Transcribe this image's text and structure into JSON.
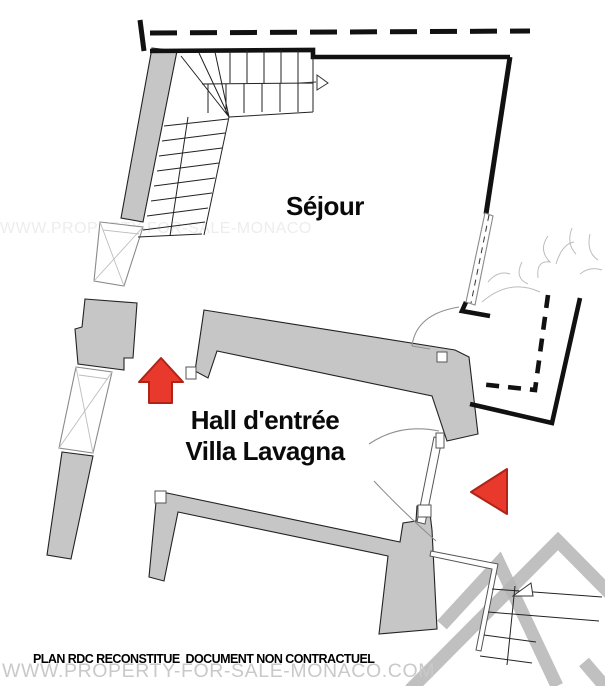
{
  "title": "Villa Lavagna ground floor plan",
  "labels": {
    "sejour": "Séjour",
    "hall_line1": "Hall d'entrée",
    "hall_line2": "Villa Lavagna"
  },
  "footer": {
    "caption": "PLAN RDC RECONSTITUE  DOCUMENT NON CONTRACTUEL",
    "watermark": "WWW.PROPERTY-FOR-SALE-MONACO.COM"
  },
  "watermark_side": "WWW.PROPERTY-FOR-SALE-MONACO",
  "icons": {
    "entrance_arrow": "red-up-arrow-marker",
    "side_entrance_arrow": "red-left-triangle-marker",
    "stair_direction": "white-triangle-arrow"
  },
  "colors": {
    "wall-gray": "#c6c6c6",
    "line-dark": "#111111",
    "arrow-red": "#e8392c",
    "arrow-red-border": "#b02418",
    "chevron-gray": "#b5b5b5",
    "watermark-gray": "#c9c9c9",
    "watermark-faint": "#ededed",
    "sketch-gray": "#b0aaaa"
  }
}
